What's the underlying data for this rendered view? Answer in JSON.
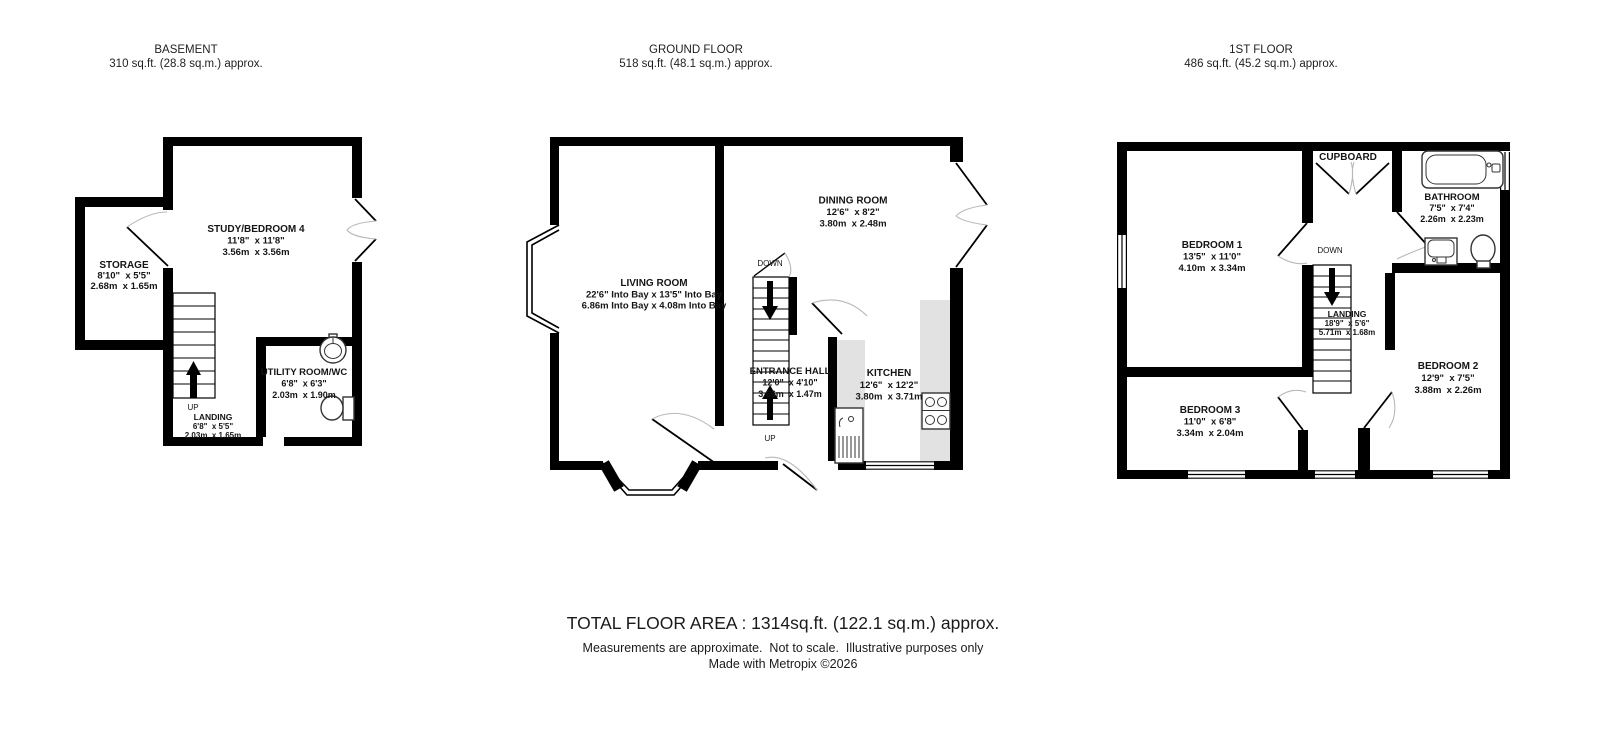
{
  "page": {
    "wall_color": "#000000",
    "counter_color": "#e2e2e2",
    "arc_color": "#b8b8b8"
  },
  "floors": [
    {
      "title": "BASEMENT",
      "area": "310 sq.ft. (28.8 sq.m.) approx.",
      "stairs": {
        "direction_label": "UP"
      },
      "rooms": [
        {
          "name": "STORAGE",
          "dims_ft": "8'10\"  x 5'5\"",
          "dims_m": "2.68m  x 1.65m"
        },
        {
          "name": "STUDY/BEDROOM 4",
          "dims_ft": "11'8\"  x 11'8\"",
          "dims_m": "3.56m  x 3.56m"
        },
        {
          "name": "UTILITY ROOM/WC",
          "dims_ft": "6'8\"  x 6'3\"",
          "dims_m": "2.03m  x 1.90m"
        },
        {
          "name": "LANDING",
          "dims_ft": "6'8\"  x 5'5\"",
          "dims_m": "2.03m  x 1.65m"
        }
      ]
    },
    {
      "title": "GROUND FLOOR",
      "area": "518 sq.ft. (48.1 sq.m.) approx.",
      "stairs": {
        "down_label": "DOWN",
        "up_label": "UP"
      },
      "rooms": [
        {
          "name": "LIVING ROOM",
          "dims_ft": "22'6\" Into Bay x 13'5\" Into Bay",
          "dims_m": "6.86m Into Bay x 4.08m Into Bay"
        },
        {
          "name": "DINING ROOM",
          "dims_ft": "12'6\"  x 8'2\"",
          "dims_m": "3.80m  x 2.48m"
        },
        {
          "name": "ENTRANCE HALL",
          "dims_ft": "12'0\"  x 4'10\"",
          "dims_m": "3.66m  x 1.47m"
        },
        {
          "name": "KITCHEN",
          "dims_ft": "12'6\"  x 12'2\"",
          "dims_m": "3.80m  x 3.71m"
        }
      ]
    },
    {
      "title": "1ST FLOOR",
      "area": "486 sq.ft. (45.2 sq.m.) approx.",
      "stairs": {
        "direction_label": "DOWN"
      },
      "rooms": [
        {
          "name": "BEDROOM 1",
          "dims_ft": "13'5\"  x 11'0\"",
          "dims_m": "4.10m  x 3.34m"
        },
        {
          "name": "CUPBOARD"
        },
        {
          "name": "BATHROOM",
          "dims_ft": "7'5\"  x 7'4\"",
          "dims_m": "2.26m  x 2.23m"
        },
        {
          "name": "LANDING",
          "dims_ft": "18'9\"  x 5'6\"",
          "dims_m": "5.71m  x 1.68m"
        },
        {
          "name": "BEDROOM 2",
          "dims_ft": "12'9\"  x 7'5\"",
          "dims_m": "3.88m  x 2.26m"
        },
        {
          "name": "BEDROOM 3",
          "dims_ft": "11'0\"  x 6'8\"",
          "dims_m": "3.34m  x 2.04m"
        }
      ]
    }
  ],
  "footer": {
    "total": "TOTAL FLOOR AREA : 1314sq.ft. (122.1 sq.m.) approx.",
    "disclaimer": "Measurements are approximate.  Not to scale.  Illustrative purposes only",
    "credit": "Made with Metropix ©2026"
  }
}
